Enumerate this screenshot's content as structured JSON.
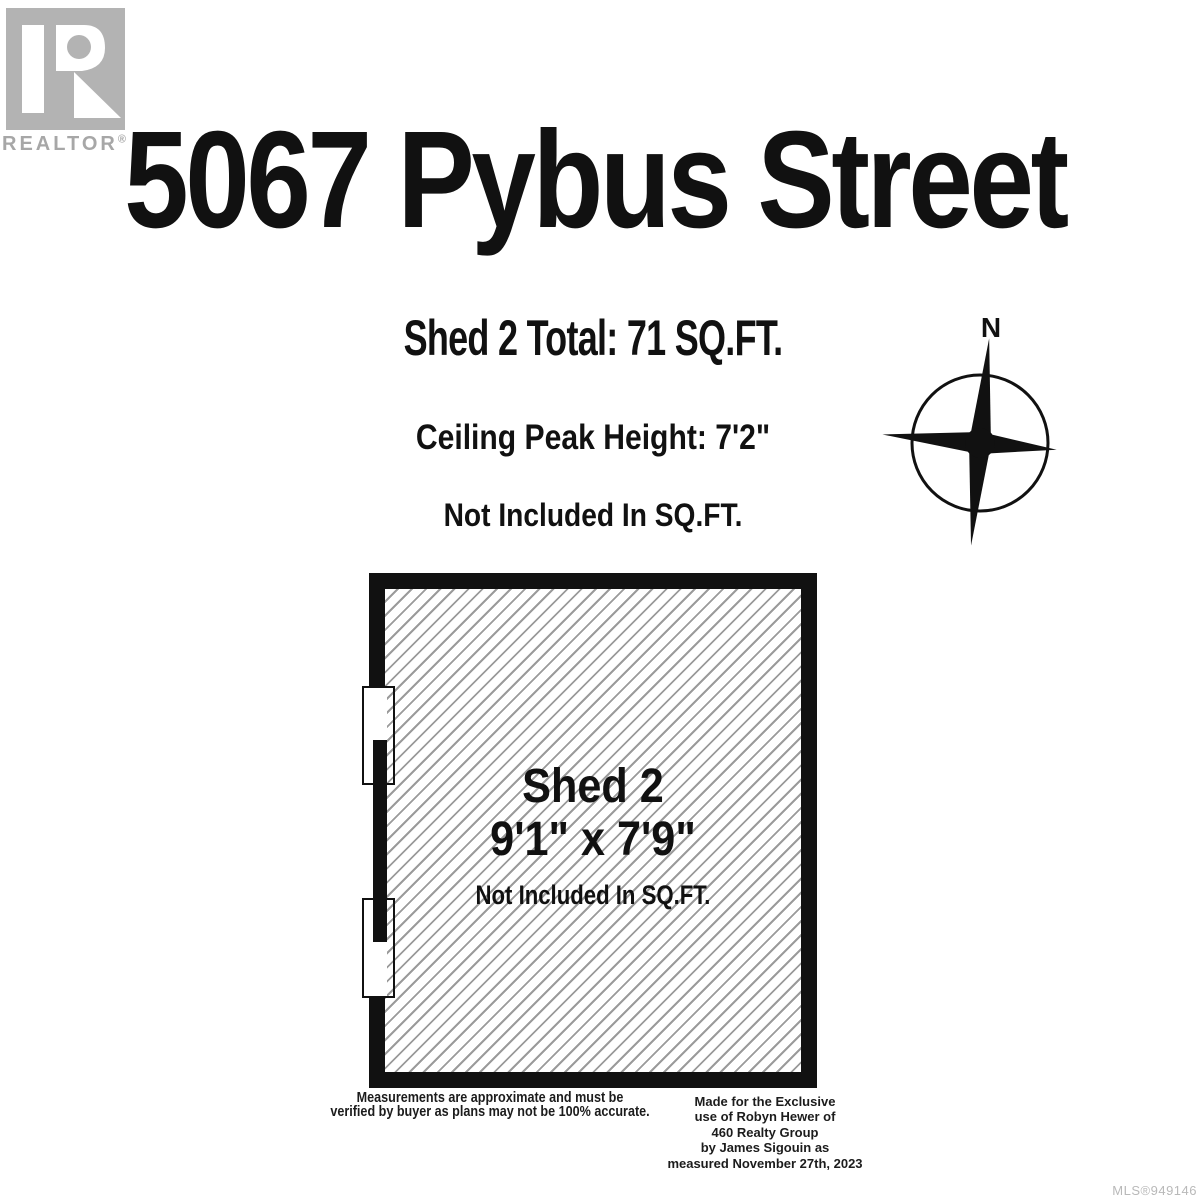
{
  "branding": {
    "wordmark": "REALTOR",
    "registered": "®"
  },
  "header": {
    "title": "5067 Pybus Street"
  },
  "summary": {
    "total": "Shed 2 Total: 71 SQ.FT.",
    "ceiling": "Ceiling Peak Height: 7'2\"",
    "note": "Not Included In SQ.FT."
  },
  "compass": {
    "north_label": "N"
  },
  "floor_plan": {
    "room_name": "Shed 2",
    "dimensions": "9'1\" x 7'9\"",
    "note": "Not Included In SQ.FT."
  },
  "footer": {
    "disclaimer_line1": "Measurements are approximate and must be",
    "disclaimer_line2": "verified by buyer as plans may not be 100% accurate.",
    "attribution_lines": [
      "Made for the Exclusive",
      "use of Robyn Hewer of",
      "460 Realty Group",
      "by James Sigouin as",
      "measured November 27th, 2023"
    ],
    "mls": "MLS®949146"
  },
  "colors": {
    "wall": "#111111",
    "hatch_line": "#9b9b9b",
    "logo_gray": "#b3b3b3",
    "muted_text": "#b9b9b9"
  }
}
